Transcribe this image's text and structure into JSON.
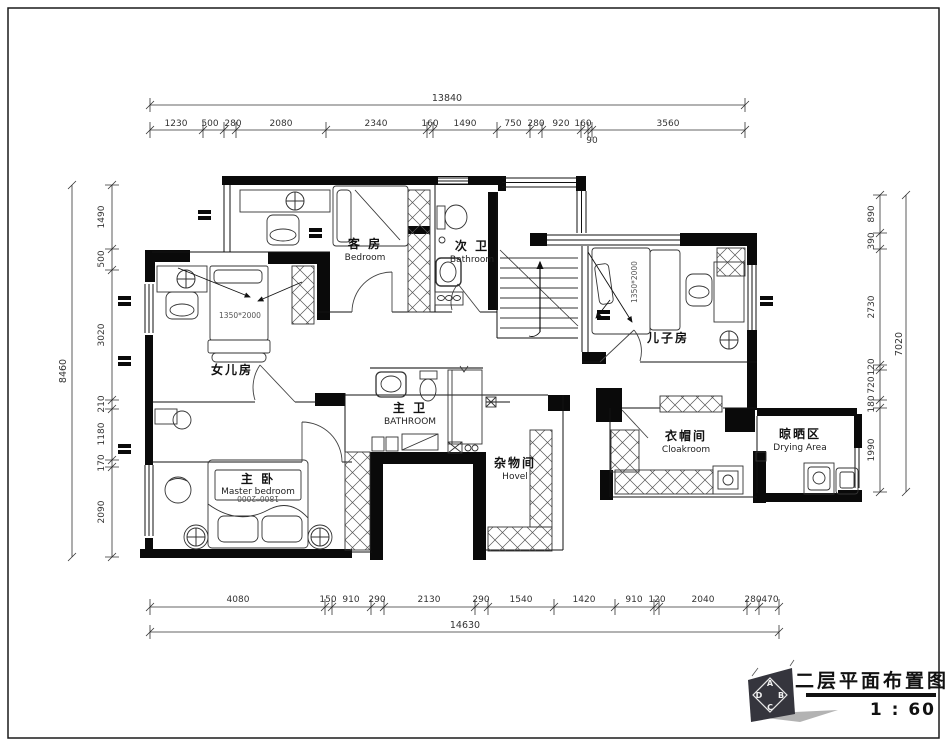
{
  "frame": {
    "title": "二层平面布置图",
    "scale": "1 : 60",
    "logo": {
      "top": "A",
      "left": "D",
      "right": "B",
      "bottom": "C"
    }
  },
  "rooms": {
    "guest": {
      "cn": "客 房",
      "en": "Bedroom"
    },
    "bath2": {
      "cn": "次 卫",
      "en": "Bathroom"
    },
    "daughter": {
      "cn": "女儿房",
      "bed": "1350*2000"
    },
    "son": {
      "cn": "儿子房",
      "bed": "1350*2000"
    },
    "master_bath": {
      "cn": "主 卫",
      "en": "BATHROOM"
    },
    "master": {
      "cn": "主 卧",
      "en": "Master bedroom",
      "bed": "1800*2000"
    },
    "hovel": {
      "cn": "杂物间",
      "en": "Hovel"
    },
    "cloak": {
      "cn": "衣帽间",
      "en": "Cloakroom"
    },
    "drying": {
      "cn": "晾晒区",
      "en": "Drying Area"
    }
  },
  "dims": {
    "top": {
      "total": "13840",
      "segs": [
        "1230",
        "500",
        "280",
        "2080",
        "2340",
        "160",
        "1490",
        "750",
        "280",
        "920",
        "160",
        "90",
        "3560"
      ]
    },
    "bottom": {
      "total": "14630",
      "segs": [
        "4080",
        "150",
        "910",
        "290",
        "2130",
        "290",
        "1540",
        "1420",
        "910",
        "120",
        "2040",
        "280",
        "470"
      ]
    },
    "left": {
      "total": "8460",
      "segs": [
        "1490",
        "500",
        "3020",
        "210",
        "1180",
        "170",
        "2090"
      ]
    },
    "right": {
      "total": "7020",
      "segs": [
        "890",
        "390",
        "2730",
        "120",
        "720",
        "180",
        "1990"
      ]
    }
  }
}
